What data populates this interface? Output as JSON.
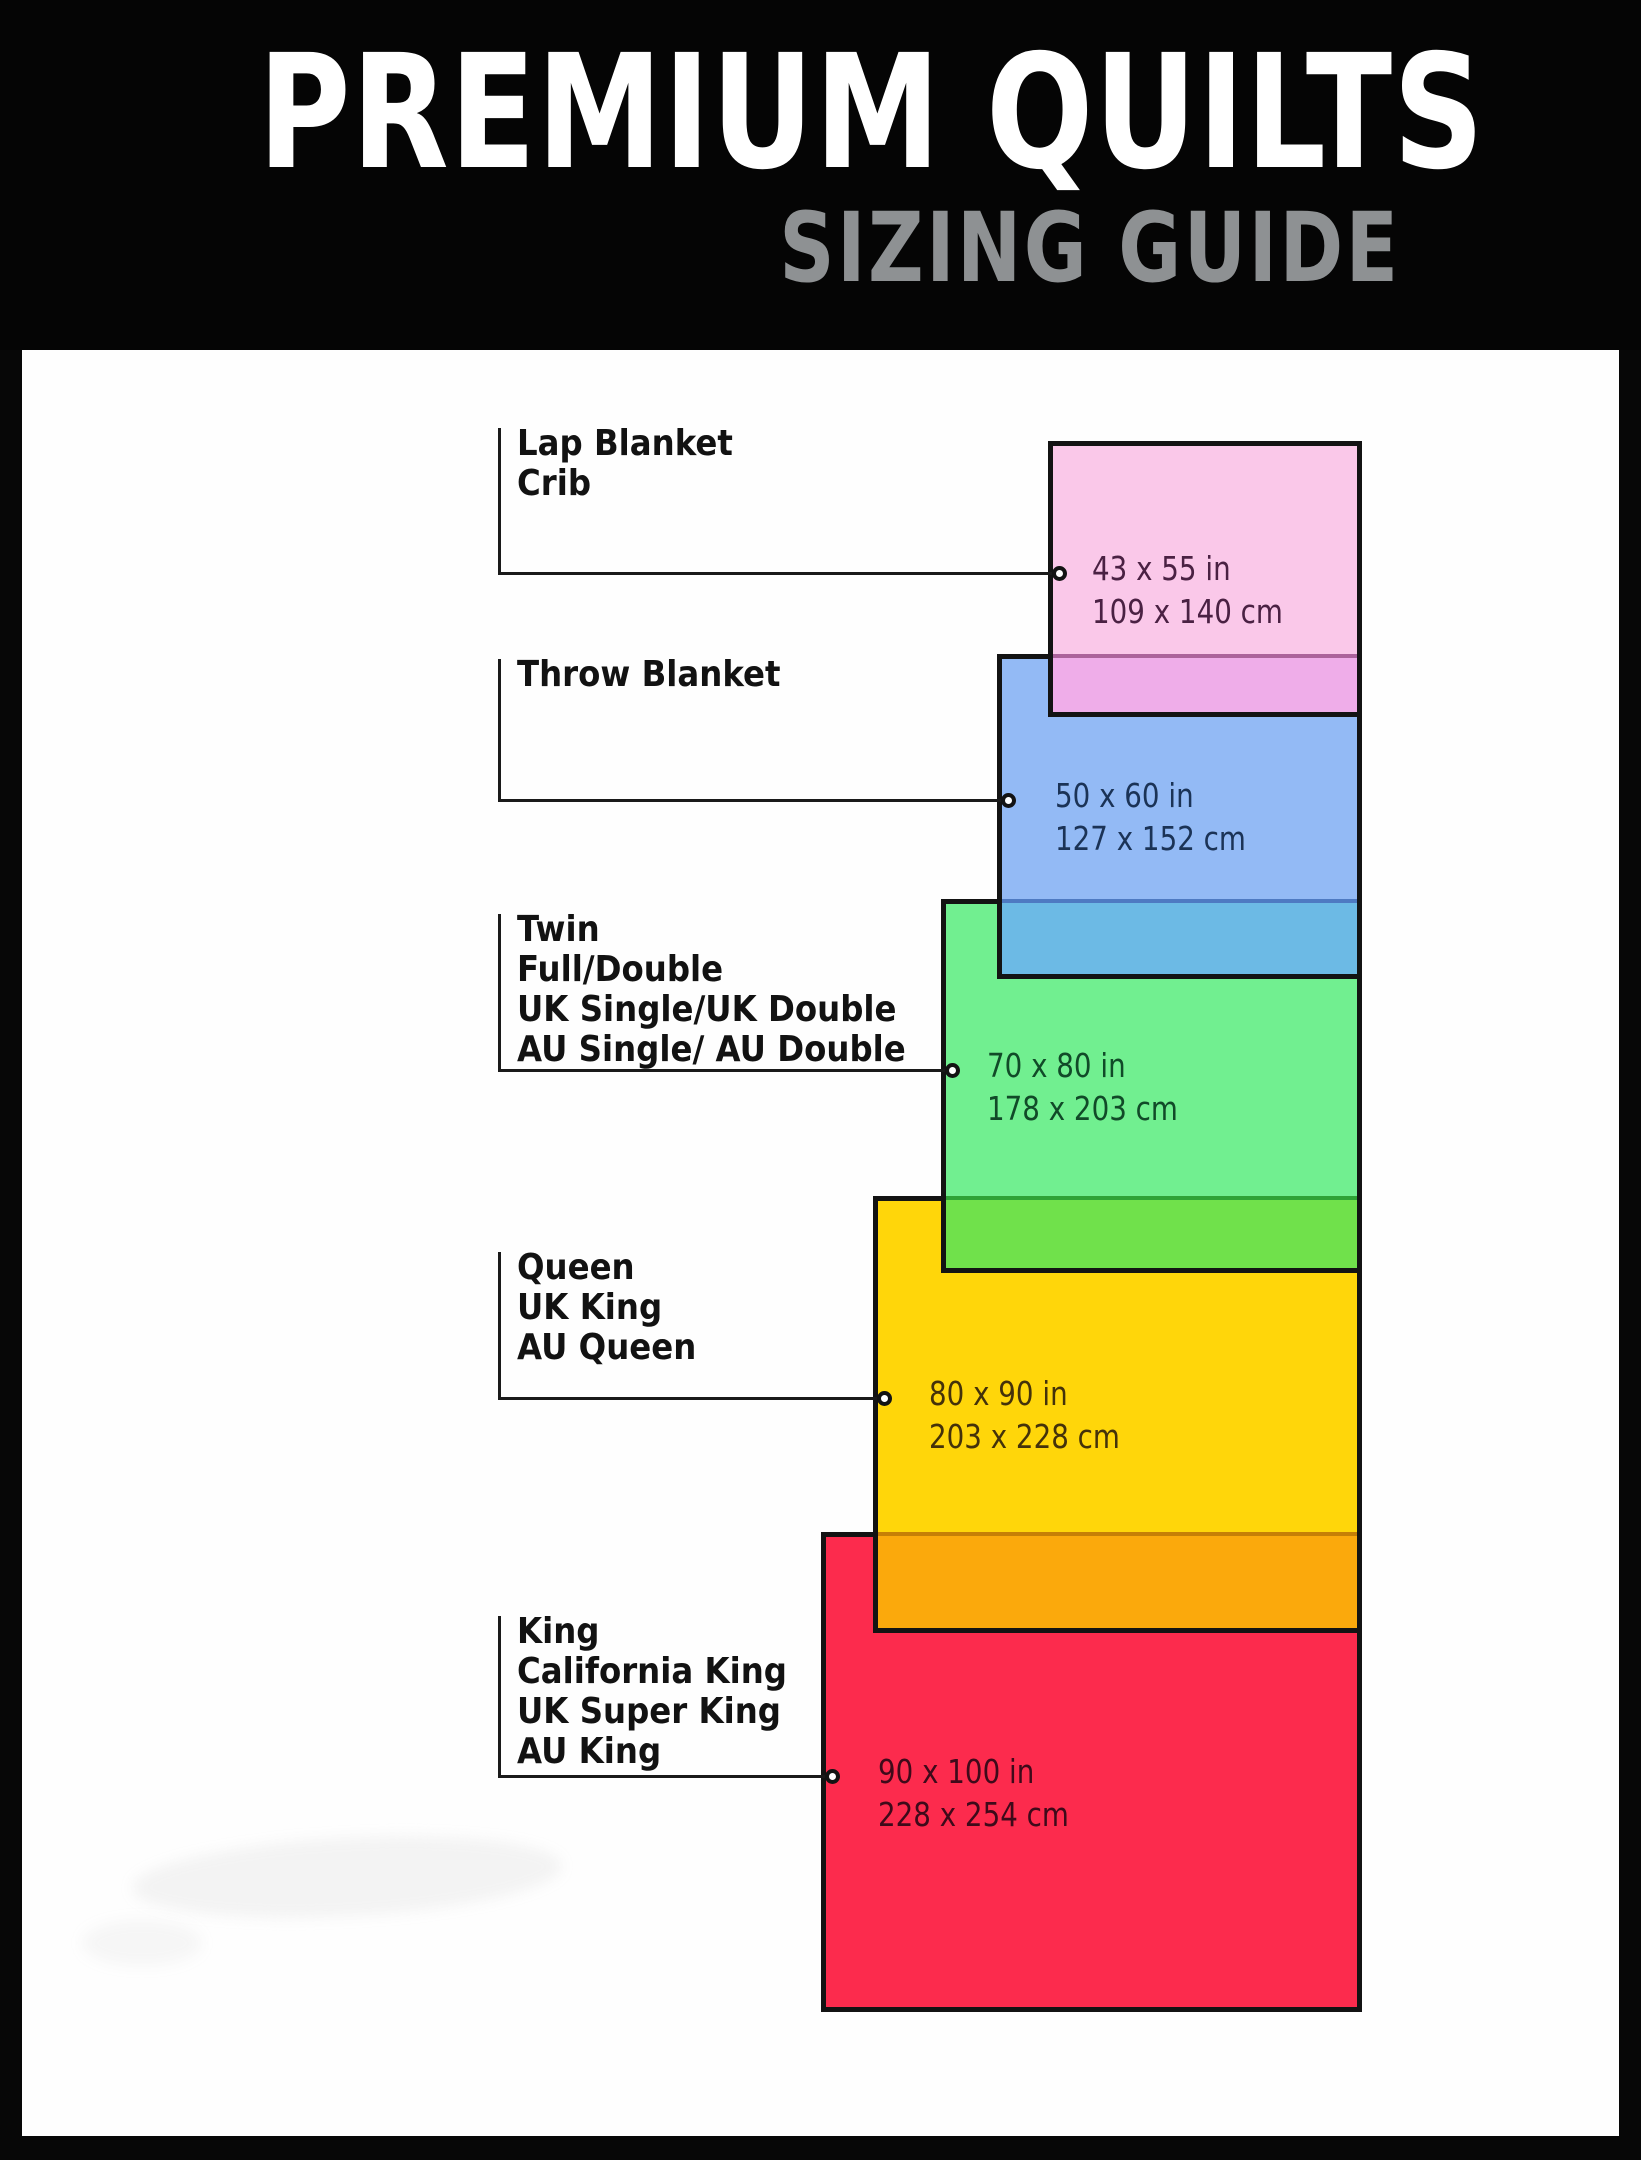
{
  "header": {
    "title": "PREMIUM QUILTS",
    "subtitle": "SIZING GUIDE",
    "title_color": "#ffffff",
    "subtitle_color": "#8e9193",
    "background": "#050505"
  },
  "panel": {
    "background": "#fefefe",
    "frame_color": "#070707"
  },
  "line_color": "#1a1a1a",
  "border_color": "#131313",
  "sizes": [
    {
      "id": "lap-crib",
      "labels": [
        "Lap Blanket",
        "Crib"
      ],
      "dim_in": "43 x 55 in",
      "dim_cm": "109 x 140 cm",
      "fill": "#FAC8E9",
      "overlap_fill": "#EFADE9",
      "overlap_line": "#AC639B",
      "text_color": "#4A2143",
      "rect": {
        "left": 1048,
        "top": 441,
        "width": 314,
        "height": 276
      },
      "overlap_top": 654,
      "label_top": 424,
      "leader_y": 573,
      "dim_x": 1092,
      "dim_top": 547
    },
    {
      "id": "throw",
      "labels": [
        "Throw Blanket"
      ],
      "dim_in": "50 x 60 in",
      "dim_cm": "127 x 152 cm",
      "fill": "#93BAF5",
      "overlap_fill": "#6CBAE5",
      "overlap_line": "#4E7AC2",
      "text_color": "#1B3356",
      "rect": {
        "left": 997,
        "top": 654,
        "width": 365,
        "height": 325
      },
      "overlap_top": 899,
      "label_top": 655,
      "leader_y": 800,
      "dim_x": 1055,
      "dim_top": 774
    },
    {
      "id": "twin-full",
      "labels": [
        "Twin",
        "Full/Double",
        "UK Single/UK Double",
        "AU Single/ AU Double"
      ],
      "dim_in": "70 x 80 in",
      "dim_cm": "178 x 203 cm",
      "fill": "#71EF90",
      "overlap_fill": "#70E14B",
      "overlap_line": "#2EA336",
      "text_color": "#114A28",
      "rect": {
        "left": 941,
        "top": 899,
        "width": 421,
        "height": 374
      },
      "overlap_top": 1196,
      "label_top": 910,
      "leader_y": 1070,
      "dim_x": 987,
      "dim_top": 1044
    },
    {
      "id": "queen",
      "labels": [
        "Queen",
        "UK King",
        "AU Queen"
      ],
      "dim_in": "80 x 90 in",
      "dim_cm": "203 x 228 cm",
      "fill": "#FFD60A",
      "overlap_fill": "#FBA90C",
      "overlap_line": "#C67F06",
      "text_color": "#44320A",
      "rect": {
        "left": 873,
        "top": 1196,
        "width": 489,
        "height": 437
      },
      "overlap_top": 1532,
      "label_top": 1248,
      "leader_y": 1398,
      "dim_x": 929,
      "dim_top": 1372
    },
    {
      "id": "king",
      "labels": [
        "King",
        "California King",
        "UK Super King",
        "AU King"
      ],
      "dim_in": "90 x 100 in",
      "dim_cm": "228 x 254 cm",
      "fill": "#FC2B4D",
      "overlap_fill": null,
      "overlap_line": null,
      "text_color": "#3E0A1A",
      "rect": {
        "left": 821,
        "top": 1532,
        "width": 541,
        "height": 480
      },
      "overlap_top": null,
      "label_top": 1612,
      "leader_y": 1776,
      "dim_x": 878,
      "dim_top": 1750
    }
  ],
  "layout_constants": {
    "bracket_x": 498,
    "label_text_x": 517,
    "circle_inset": 11
  }
}
